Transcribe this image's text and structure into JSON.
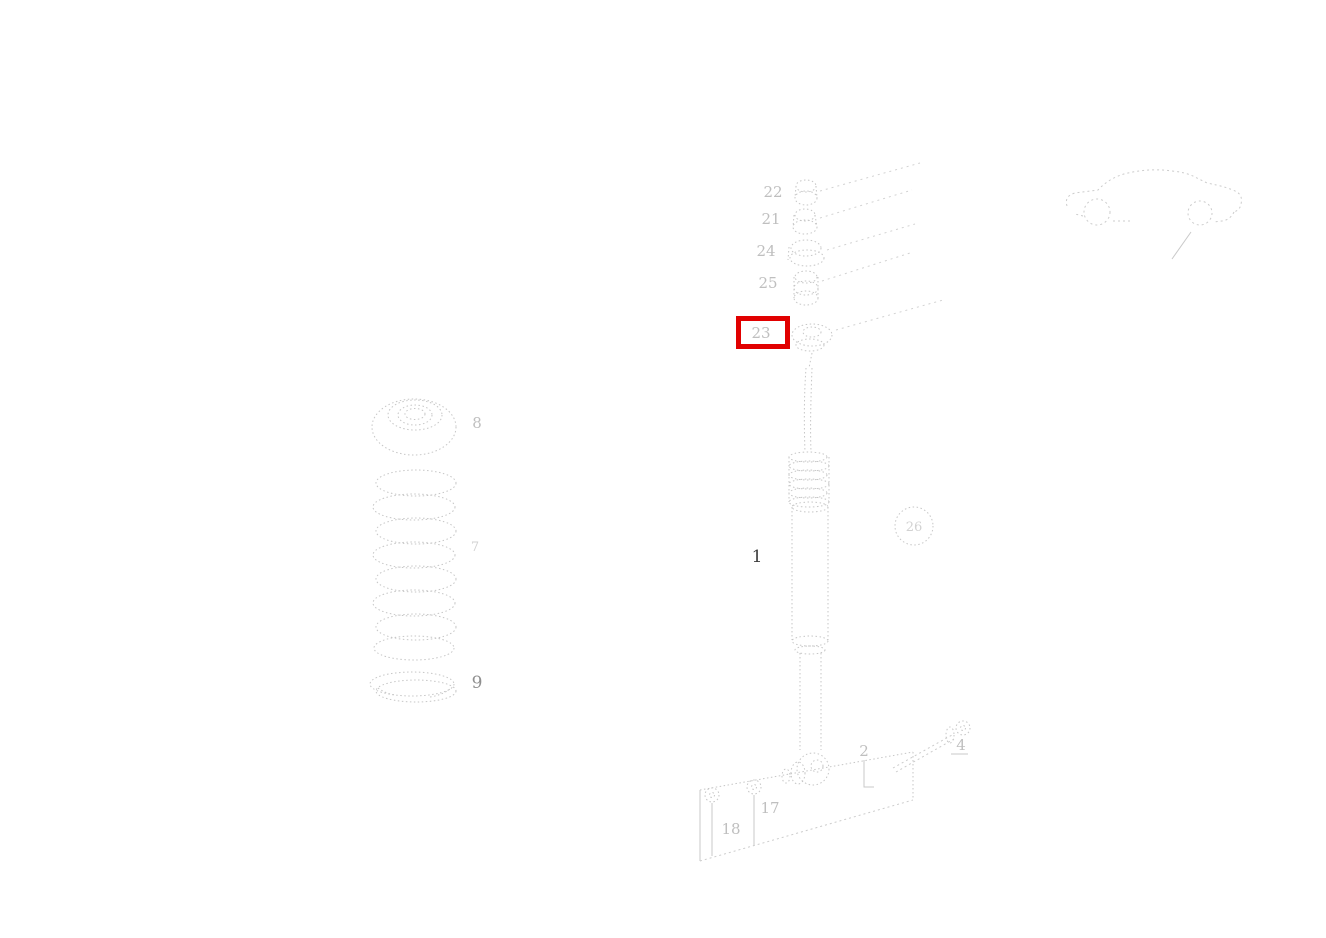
{
  "diagram": {
    "description_colors": {
      "background": "#ffffff",
      "line": "#c9c9c9",
      "label": "#bfbfbf",
      "label_dark": "#3d3d3d",
      "highlight": "#e10000"
    },
    "callouts": {
      "stack": [
        {
          "label": "22"
        },
        {
          "label": "21"
        },
        {
          "label": "24"
        },
        {
          "label": "25"
        },
        {
          "label": "23",
          "highlighted": true
        }
      ],
      "top_mount": {
        "label": "8"
      },
      "coil_spring": {
        "label": "7"
      },
      "spring_retainer": {
        "label": "9"
      },
      "shock_absorber": {
        "label": "1"
      },
      "circled": {
        "label": "26"
      },
      "bolt_left": {
        "label": "18"
      },
      "bolt_right": {
        "label": "17"
      },
      "fastener_screw": {
        "label": "2"
      },
      "fastener_bolt": {
        "label": "4"
      }
    }
  }
}
